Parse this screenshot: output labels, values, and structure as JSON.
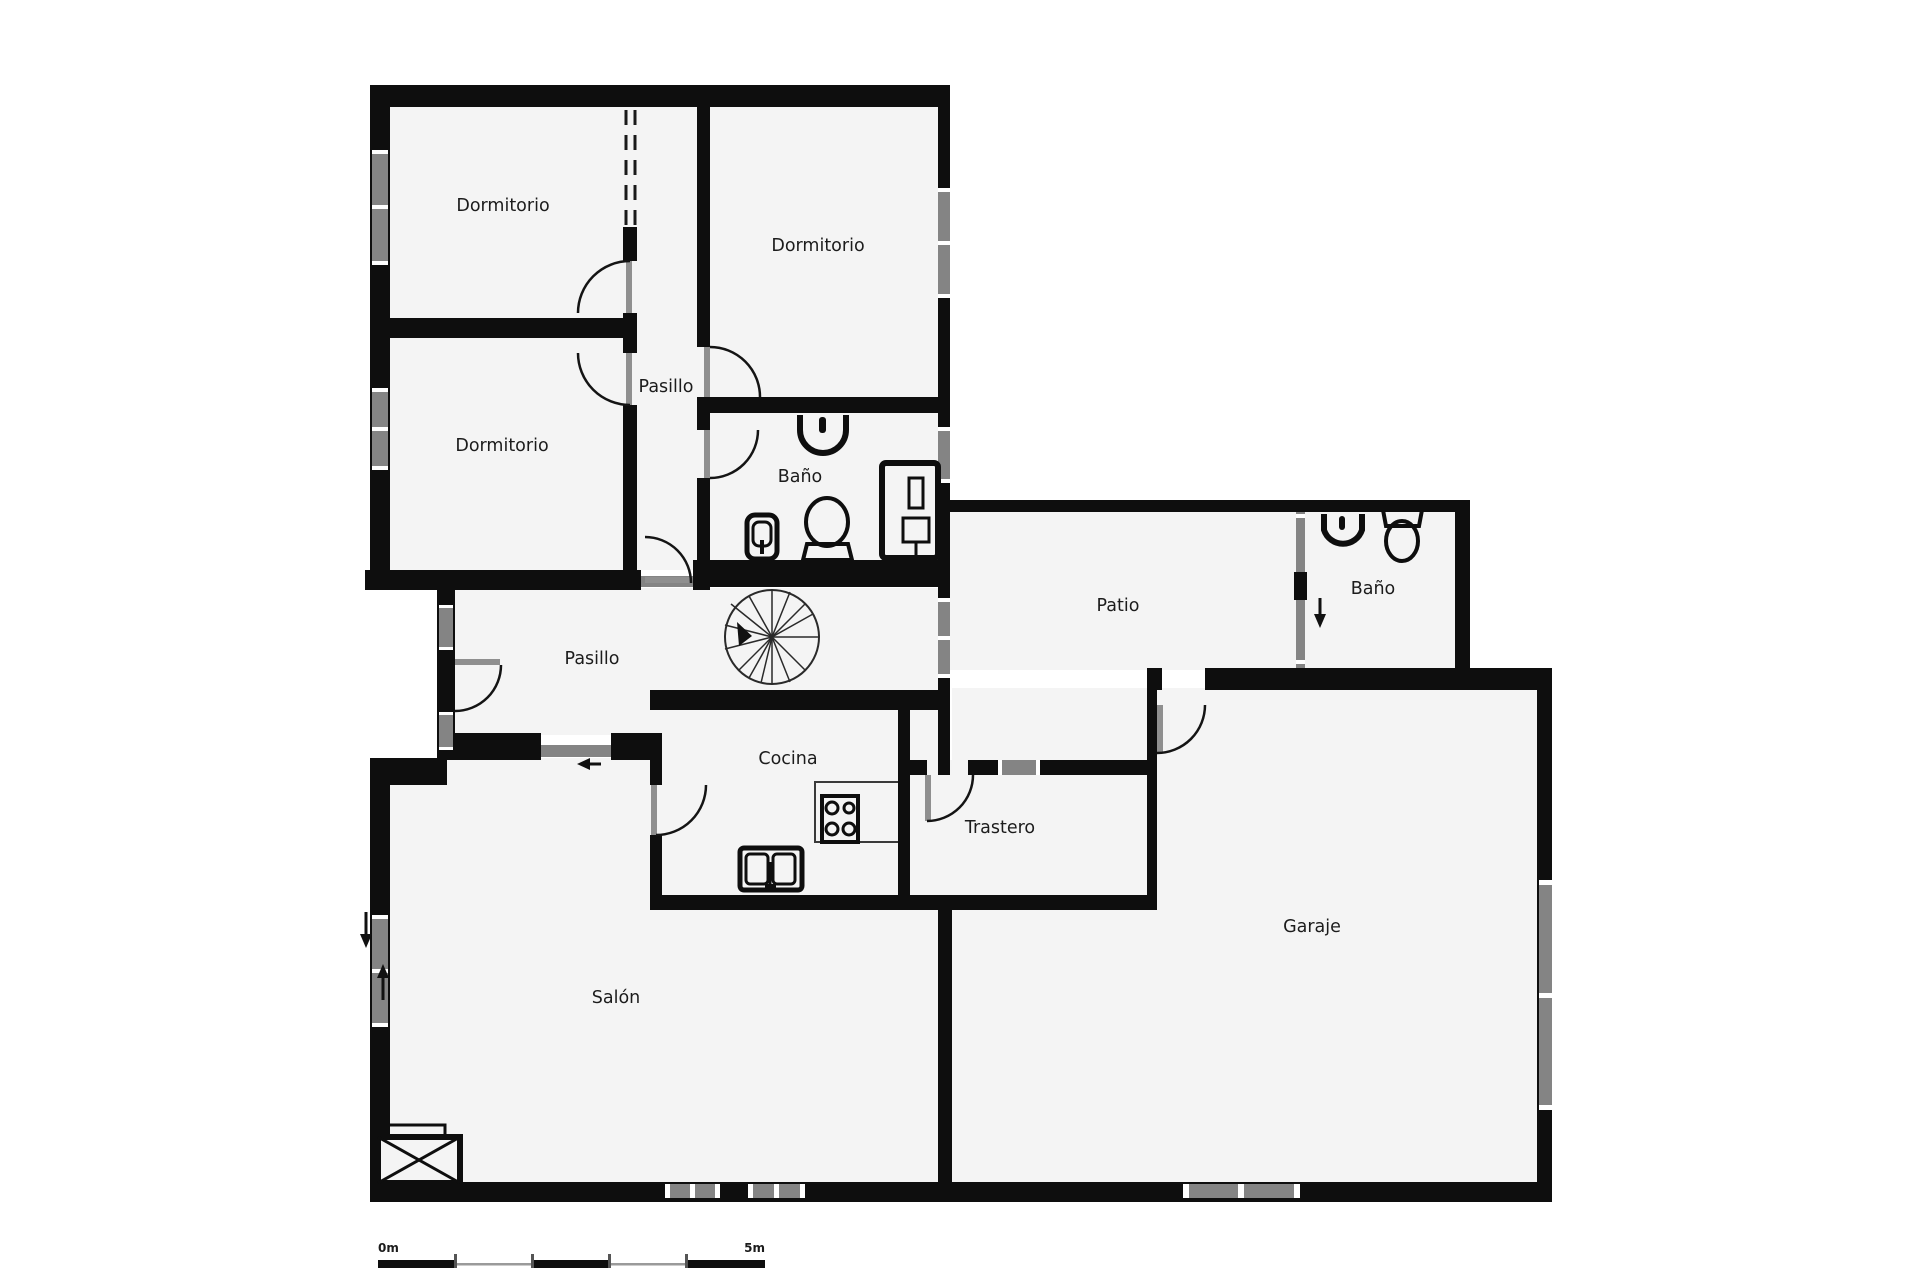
{
  "plan": {
    "rooms": [
      {
        "id": "dormitorio-1",
        "label": "Dormitorio",
        "x": 503,
        "y": 205
      },
      {
        "id": "dormitorio-2",
        "label": "Dormitorio",
        "x": 818,
        "y": 245
      },
      {
        "id": "dormitorio-3",
        "label": "Dormitorio",
        "x": 502,
        "y": 445
      },
      {
        "id": "pasillo-1",
        "label": "Pasillo",
        "x": 666,
        "y": 386
      },
      {
        "id": "bano-1",
        "label": "Baño",
        "x": 800,
        "y": 476
      },
      {
        "id": "patio",
        "label": "Patio",
        "x": 1118,
        "y": 605
      },
      {
        "id": "bano-2",
        "label": "Baño",
        "x": 1373,
        "y": 588
      },
      {
        "id": "pasillo-2",
        "label": "Pasillo",
        "x": 592,
        "y": 658
      },
      {
        "id": "cocina",
        "label": "Cocina",
        "x": 788,
        "y": 758
      },
      {
        "id": "trastero",
        "label": "Trastero",
        "x": 1000,
        "y": 827
      },
      {
        "id": "salon",
        "label": "Salón",
        "x": 616,
        "y": 997
      },
      {
        "id": "garaje",
        "label": "Garaje",
        "x": 1312,
        "y": 926
      }
    ],
    "fixtures": [
      {
        "name": "sink-icon",
        "room": "Baño"
      },
      {
        "name": "bidet-icon",
        "room": "Baño"
      },
      {
        "name": "toilet-icon",
        "room": "Baño"
      },
      {
        "name": "shower-icon",
        "room": "Baño"
      },
      {
        "name": "sink-icon",
        "room": "Baño"
      },
      {
        "name": "toilet-icon",
        "room": "Baño"
      },
      {
        "name": "stove-icon",
        "room": "Cocina"
      },
      {
        "name": "kitchen-sink-icon",
        "room": "Cocina"
      },
      {
        "name": "spiral-stair-icon",
        "room": "Pasillo"
      },
      {
        "name": "fireplace-icon",
        "room": "Salón"
      }
    ],
    "scale_bar": {
      "start": "0m",
      "end": "5m"
    },
    "colors": {
      "wall": "#0e0e0e",
      "room_fill": "#f4f4f4",
      "window": "#848484",
      "background": "#ffffff",
      "label": "#1c1c1c"
    }
  }
}
